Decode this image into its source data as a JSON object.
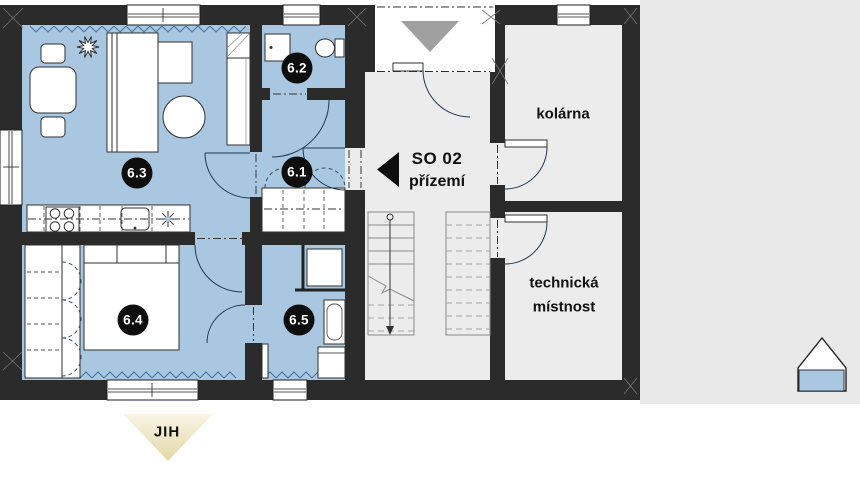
{
  "plan": {
    "block_label": "SO 02",
    "floor_label": "přízemí",
    "room_badges": [
      {
        "number": "6.1"
      },
      {
        "number": "6.2"
      },
      {
        "number": "6.3"
      },
      {
        "number": "6.4"
      },
      {
        "number": "6.5"
      }
    ],
    "room_names": {
      "bike_room": "kolárna",
      "technical_room_line1": "technická",
      "technical_room_line2": "místnost"
    },
    "compass": {
      "south": "JIH"
    },
    "colors": {
      "wall": "#2b2b2b",
      "apartment_fill": "#a9c7e1",
      "common_fill": "#ececec",
      "site_fill": "#e9e9e9",
      "entrance_arrow": "#a0a0a0",
      "insulation_line": "#46749e",
      "badge_fill": "#0e0e0e",
      "compass_fill": "#eadfb4"
    }
  }
}
